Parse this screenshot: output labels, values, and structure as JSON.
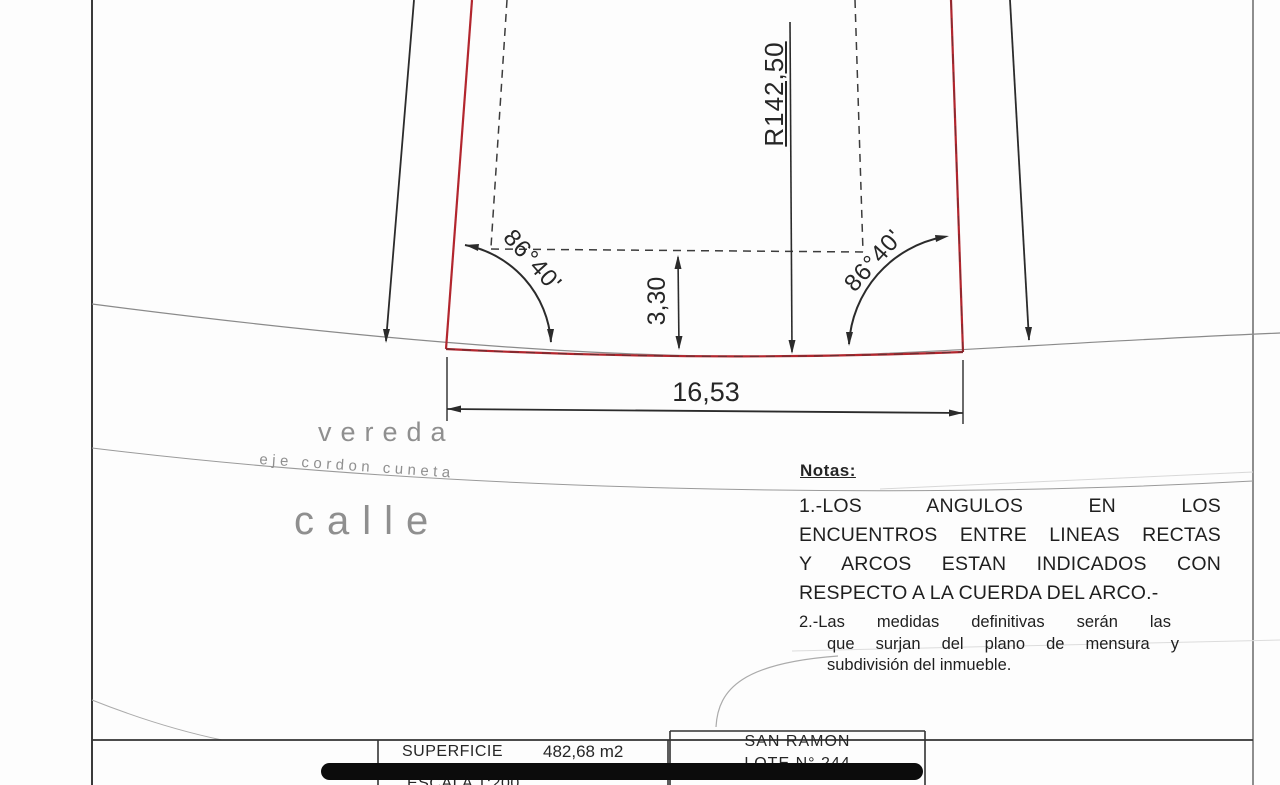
{
  "colors": {
    "boundary_red": "#b2262e",
    "ink": "#2b2b2b",
    "muted_gray": "#8f8f8f"
  },
  "plan": {
    "radius_label": "R142,50",
    "angle_left": "86°40'",
    "angle_right": "86°40'",
    "offset_label": "3,30",
    "frontage_label": "16,53"
  },
  "street": {
    "vereda": "vereda",
    "eje": "eje cordon cuneta",
    "calle": "calle"
  },
  "notes": {
    "title": "Notas:",
    "note1_lines": [
      "1.-LOS ANGULOS EN LOS",
      "ENCUENTROS ENTRE LINEAS RECTAS",
      "Y ARCOS ESTAN INDICADOS CON",
      "RESPECTO A LA CUERDA DEL ARCO.-"
    ],
    "note2_lines": [
      "2.-Las medidas definitivas serán las",
      "que surjan del plano de mensura y",
      "subdivisión del inmueble."
    ]
  },
  "title_block": {
    "superficie_label": "SUPERFICIE",
    "superficie_value": "482,68 m2",
    "escala": "ESCALA 1:200",
    "locality": "SAN RAMON",
    "lote": "LOTE N°  244"
  }
}
